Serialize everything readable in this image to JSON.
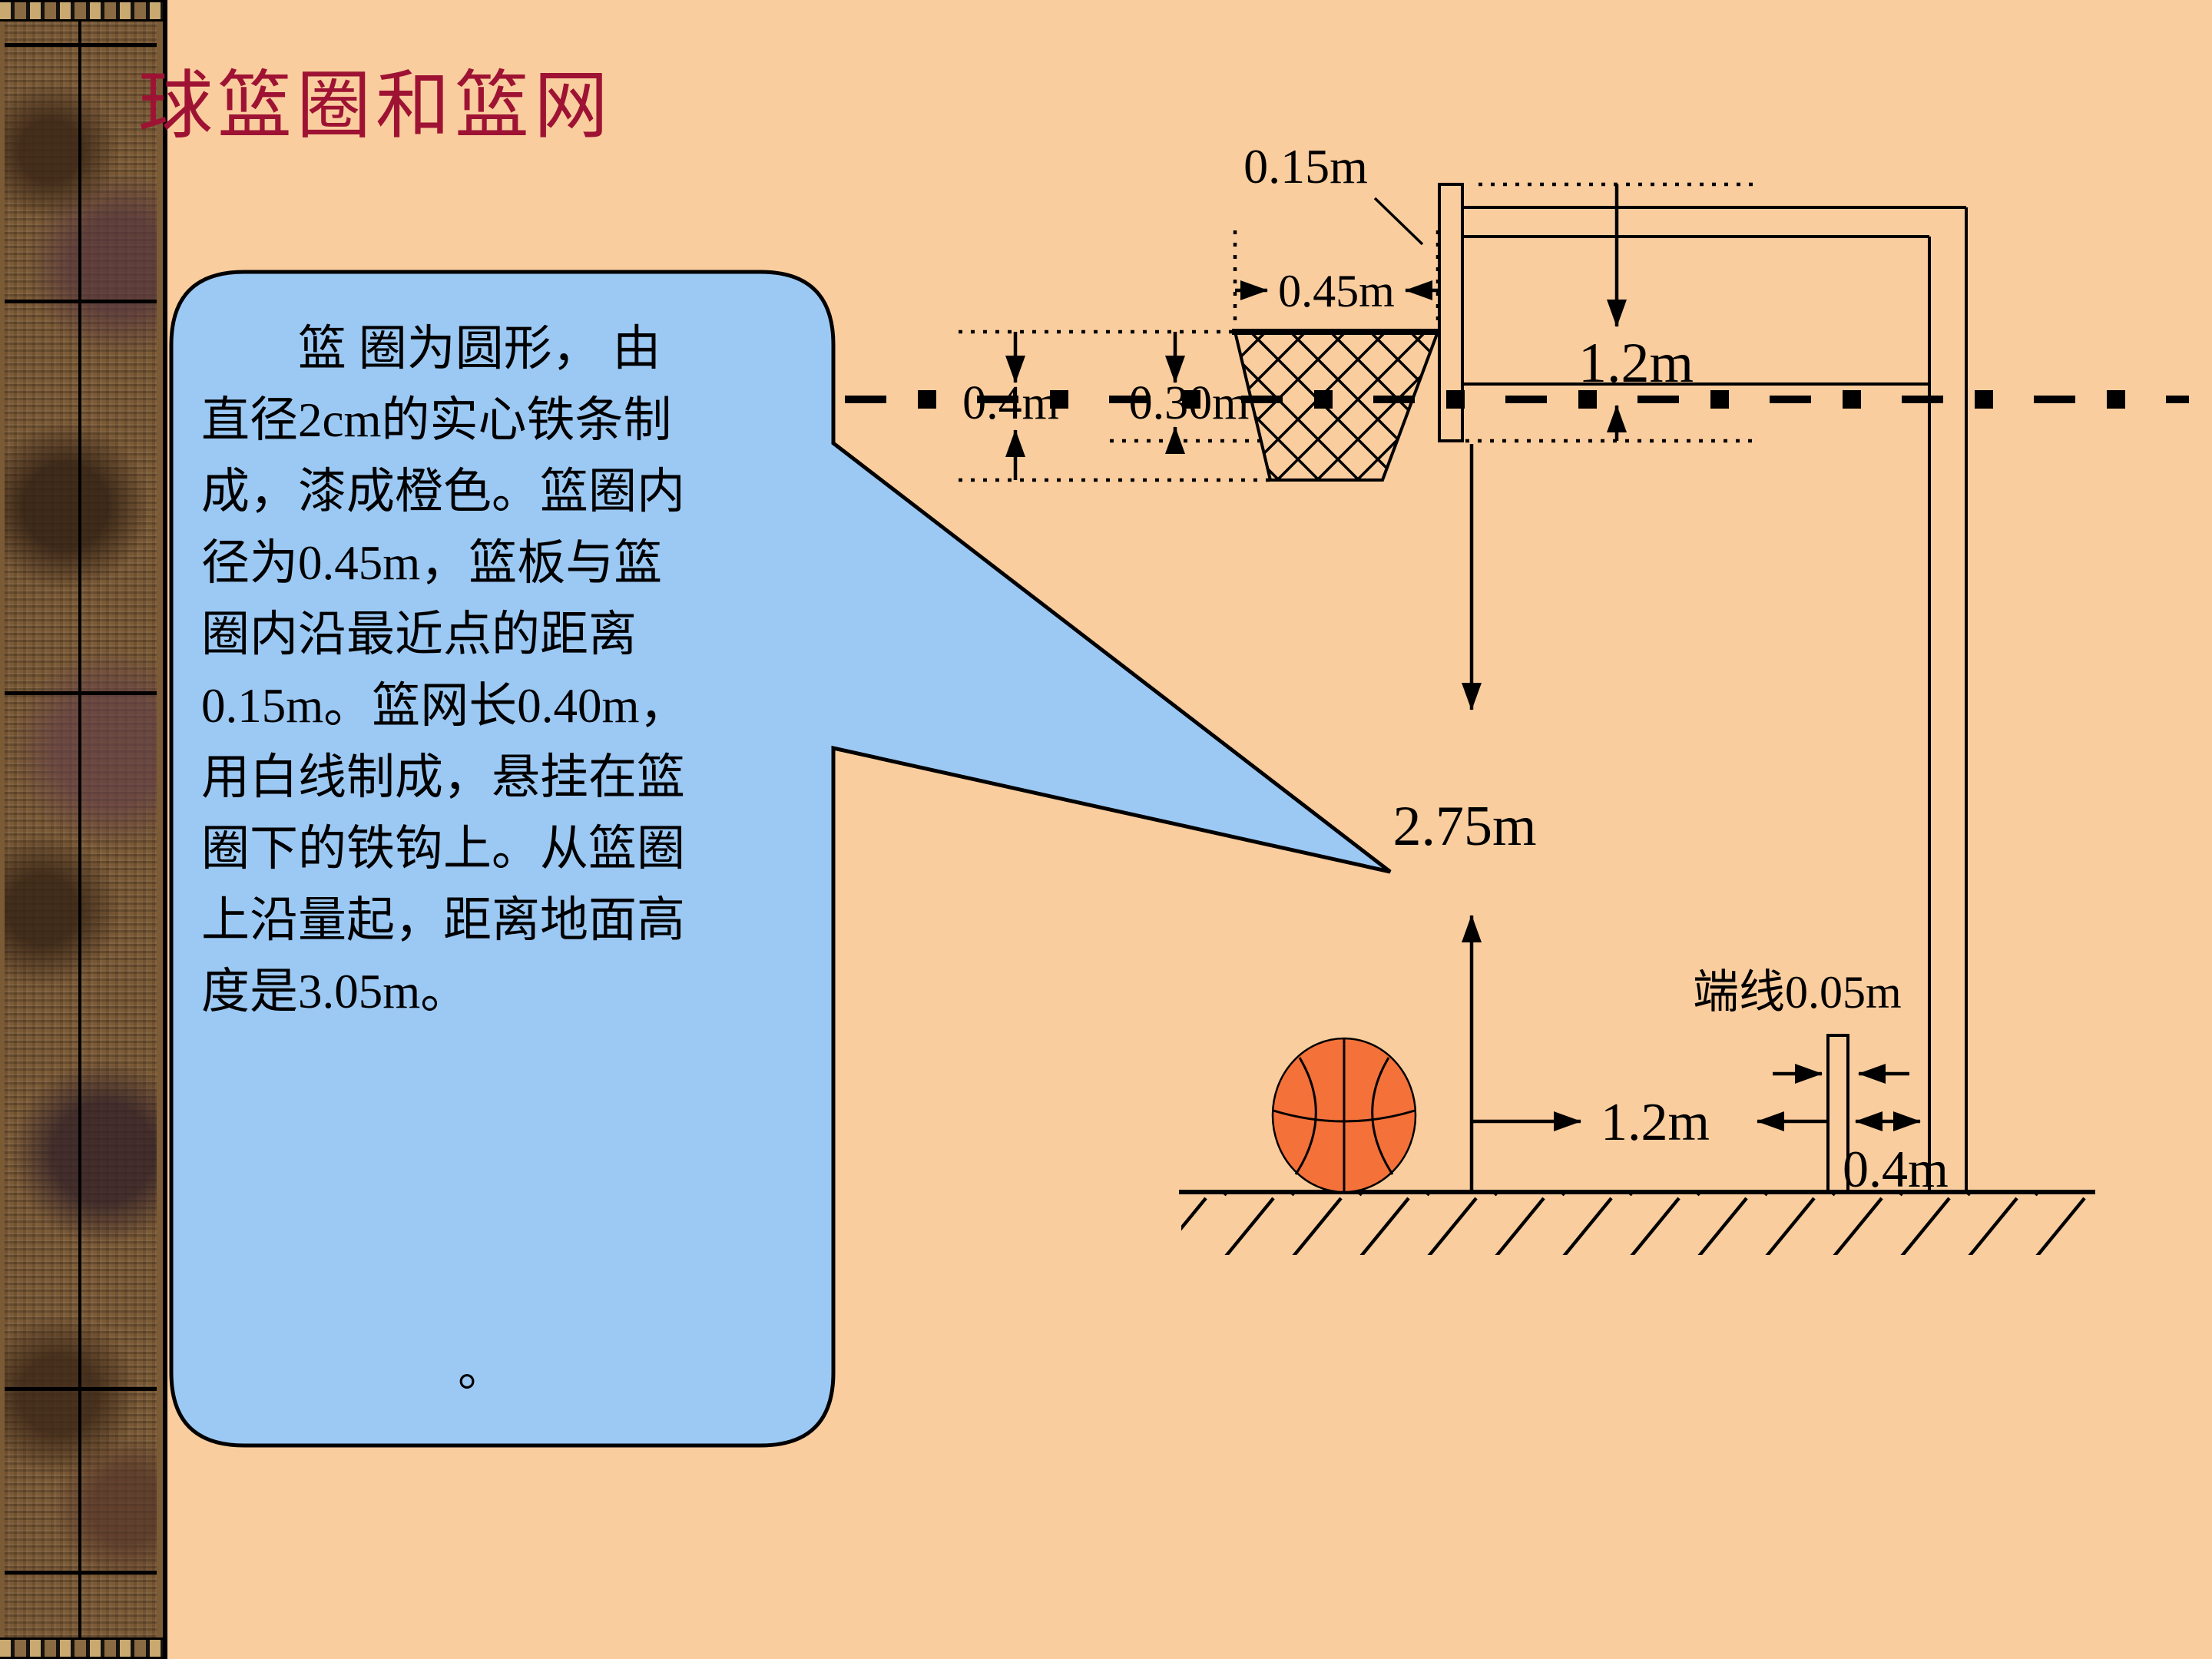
{
  "slide": {
    "background_color": "#FACD9E",
    "accent_line_color": "#000000"
  },
  "title": {
    "text": "球篮圈和篮网",
    "color": "#9E1333"
  },
  "speech_bubble": {
    "fill_color": "#9CC9F4",
    "border_color": "#000000",
    "lines": [
      "　　篮 圈为圆形， 由",
      "直径2cm的实心铁条制",
      "成，漆成橙色。篮圈内",
      "径为0.45m，篮板与篮",
      "圈内沿最近点的距离",
      "0.15m。篮网长0.40m，",
      "用白线制成，悬挂在篮",
      "圈下的铁钩上。从篮圈",
      "上沿量起，距离地面高",
      "度是3.05m。"
    ],
    "footnote": "。"
  },
  "diagram": {
    "basketball_color": "#F4713A",
    "labels": {
      "board_rim_gap": "0.15m",
      "rim_diameter": "0.45m",
      "backboard_height": "1.2m",
      "net_length": "0.4m",
      "rim_above_board_bottom": "0.30m",
      "ground_to_board_bottom": "2.75m",
      "endline": "端线0.05m",
      "line_to_endline": "1.2m",
      "endline_to_pole": "0.4m"
    }
  }
}
